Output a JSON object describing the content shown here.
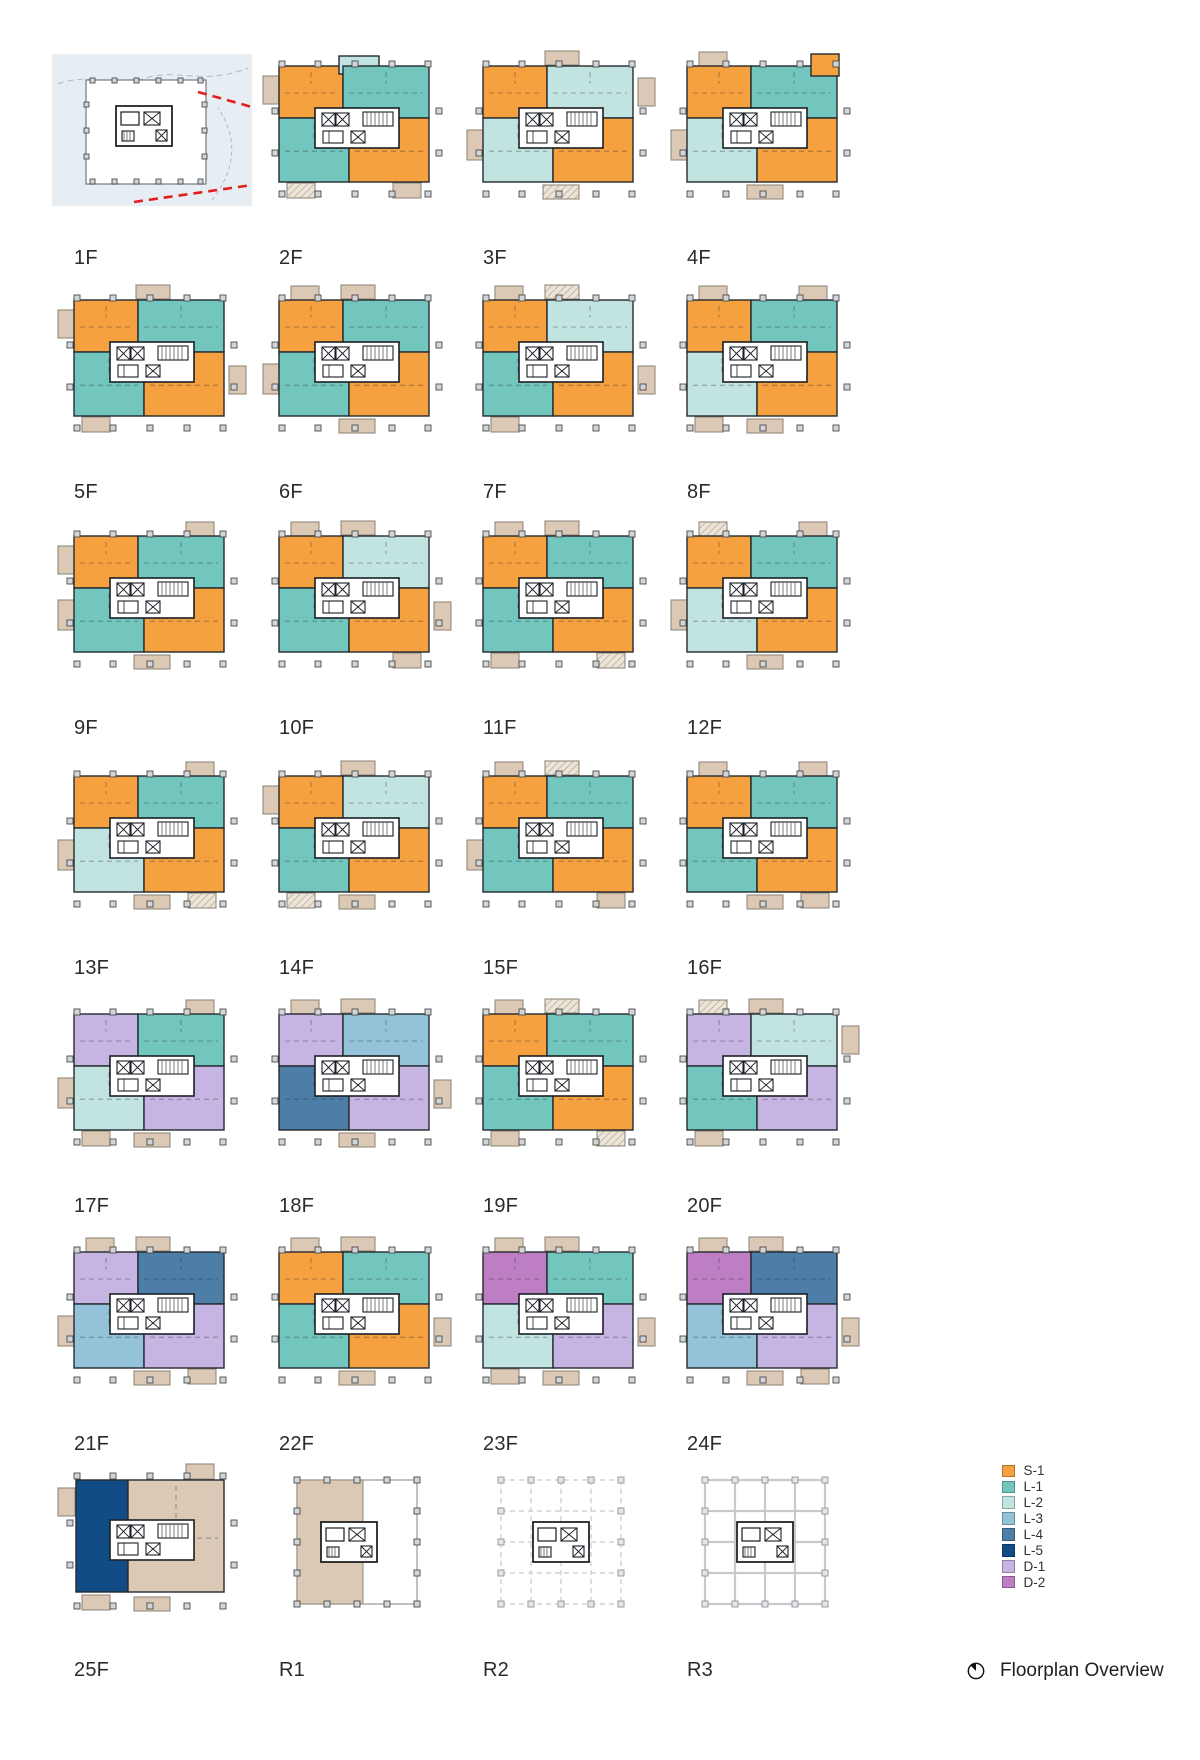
{
  "palette": {
    "S-1": "#F5A140",
    "L-1": "#72C6BD",
    "L-2": "#C2E4E1",
    "L-3": "#94C2D8",
    "L-4": "#4D7EA7",
    "L-5": "#124C87",
    "D-1": "#C6B5E2",
    "D-2": "#BD7EC3",
    "TAN": "#DBC8B5",
    "TAN_BORDER": "#938A7E",
    "UNIT_STROKE": "#232A2F",
    "CORE_STROKE": "#1A1F24",
    "COLUMN_FILL": "#D3D6D8",
    "COLUMN_STROKE": "#4A4A4A",
    "SITE_BG": "#E7EEF3",
    "SITE_LINE_RED": "#E02020",
    "SITE_GREY": "#ADB9C0",
    "ROOF_GRID": "#C6CACF"
  },
  "legend": {
    "items": [
      {
        "key": "S-1",
        "color": "#F5A140"
      },
      {
        "key": "L-1",
        "color": "#72C6BD"
      },
      {
        "key": "L-2",
        "color": "#C2E4E1"
      },
      {
        "key": "L-3",
        "color": "#94C2D8"
      },
      {
        "key": "L-4",
        "color": "#4D7EA7"
      },
      {
        "key": "L-5",
        "color": "#124C87"
      },
      {
        "key": "D-1",
        "color": "#C6B5E2"
      },
      {
        "key": "D-2",
        "color": "#BD7EC3"
      }
    ]
  },
  "footer": {
    "icon": "compass-icon",
    "label": "Floorplan Overview"
  },
  "floors": [
    {
      "label": "1F",
      "type": "site"
    },
    {
      "label": "2F",
      "type": "units",
      "units": {
        "tl": "S-1",
        "tc": "L-2",
        "tr": "L-1",
        "bl": "L-1",
        "br": "S-1"
      },
      "balconies": [
        "lt",
        "bl*",
        "br"
      ]
    },
    {
      "label": "3F",
      "type": "units",
      "units": {
        "tl": "S-1",
        "tr": "L-2",
        "bl": "L-2",
        "br": "S-1"
      },
      "balconies": [
        "tc",
        "lm",
        "rt",
        "bc*"
      ]
    },
    {
      "label": "4F",
      "type": "units",
      "units": {
        "tl": "S-1",
        "tr": "L-1",
        "trx": "S-1",
        "bl": "L-2",
        "br": "S-1"
      },
      "balconies": [
        "tl",
        "lm",
        "bc"
      ]
    },
    {
      "label": "5F",
      "type": "units",
      "units": {
        "tl": "S-1",
        "tr": "L-1",
        "bl": "L-1",
        "br": "S-1"
      },
      "balconies": [
        "tc",
        "lt",
        "rm",
        "bl"
      ]
    },
    {
      "label": "6F",
      "type": "units",
      "units": {
        "tl": "S-1",
        "tr": "L-1",
        "bl": "L-1",
        "br": "S-1"
      },
      "balconies": [
        "tl",
        "tc",
        "lm",
        "bc"
      ]
    },
    {
      "label": "7F",
      "type": "units",
      "units": {
        "tl": "S-1",
        "tr": "L-2",
        "bl": "L-1",
        "br": "S-1"
      },
      "balconies": [
        "tl",
        "tc*",
        "bl",
        "rm"
      ]
    },
    {
      "label": "8F",
      "type": "units",
      "units": {
        "tl": "S-1",
        "tr": "L-1",
        "bl": "L-2",
        "br": "S-1"
      },
      "balconies": [
        "tl",
        "tr",
        "bl",
        "bc"
      ]
    },
    {
      "label": "9F",
      "type": "units",
      "units": {
        "tl": "S-1",
        "tr": "L-1",
        "bl": "L-1",
        "br": "S-1"
      },
      "balconies": [
        "lt",
        "tr",
        "lm",
        "bc"
      ]
    },
    {
      "label": "10F",
      "type": "units",
      "units": {
        "tl": "S-1",
        "tr": "L-2",
        "bl": "L-1",
        "br": "S-1"
      },
      "balconies": [
        "tl",
        "tc",
        "rm",
        "br"
      ]
    },
    {
      "label": "11F",
      "type": "units",
      "units": {
        "tl": "S-1",
        "tr": "L-1",
        "bl": "L-1",
        "br": "S-1"
      },
      "balconies": [
        "tl",
        "tc",
        "bl",
        "br*"
      ]
    },
    {
      "label": "12F",
      "type": "units",
      "units": {
        "tl": "S-1",
        "tr": "L-1",
        "bl": "L-2",
        "br": "S-1"
      },
      "balconies": [
        "tl*",
        "tr",
        "lm",
        "bc"
      ]
    },
    {
      "label": "13F",
      "type": "units",
      "units": {
        "tl": "S-1",
        "tr": "L-1",
        "bl": "L-2",
        "br": "S-1"
      },
      "balconies": [
        "tr",
        "lm",
        "bc",
        "br*"
      ]
    },
    {
      "label": "14F",
      "type": "units",
      "units": {
        "tl": "S-1",
        "tr": "L-2",
        "bl": "L-1",
        "br": "S-1"
      },
      "balconies": [
        "tc",
        "lt",
        "bl*",
        "bc"
      ]
    },
    {
      "label": "15F",
      "type": "units",
      "units": {
        "tl": "S-1",
        "tr": "L-1",
        "bl": "L-1",
        "br": "S-1"
      },
      "balconies": [
        "tl",
        "tc*",
        "lm",
        "br"
      ]
    },
    {
      "label": "16F",
      "type": "units",
      "units": {
        "tl": "S-1",
        "tr": "L-1",
        "bl": "L-1",
        "br": "S-1"
      },
      "balconies": [
        "tl",
        "tr",
        "bc",
        "br"
      ]
    },
    {
      "label": "17F",
      "type": "units",
      "units": {
        "tl": "D-1",
        "tr": "L-1",
        "bl": "L-2",
        "br": "D-1"
      },
      "balconies": [
        "tr",
        "lm",
        "bl",
        "bc"
      ]
    },
    {
      "label": "18F",
      "type": "units",
      "units": {
        "tl": "D-1",
        "tr": "L-3",
        "bl": "L-4",
        "br": "D-1"
      },
      "balconies": [
        "tl",
        "tc",
        "rm",
        "bc"
      ]
    },
    {
      "label": "19F",
      "type": "units",
      "units": {
        "tl": "S-1",
        "tr": "L-1",
        "bl": "L-1",
        "br": "S-1"
      },
      "balconies": [
        "tl",
        "tc*",
        "bl",
        "br*"
      ]
    },
    {
      "label": "20F",
      "type": "units",
      "units": {
        "tl": "D-1",
        "tr": "L-2",
        "bl": "L-1",
        "br": "D-1"
      },
      "balconies": [
        "tl*",
        "tc",
        "rt",
        "bl"
      ]
    },
    {
      "label": "21F",
      "type": "units",
      "units": {
        "tl": "D-1",
        "tr": "L-4",
        "bl": "L-3",
        "br": "D-1"
      },
      "balconies": [
        "tl",
        "tc",
        "lm",
        "bc",
        "br"
      ]
    },
    {
      "label": "22F",
      "type": "units",
      "units": {
        "tl": "S-1",
        "tr": "L-1",
        "bl": "L-1",
        "br": "S-1"
      },
      "balconies": [
        "tl",
        "tc",
        "rm",
        "bc"
      ]
    },
    {
      "label": "23F",
      "type": "units",
      "units": {
        "tl": "D-2",
        "tr": "L-1",
        "bl": "L-2",
        "br": "D-1"
      },
      "balconies": [
        "tl",
        "tc",
        "rm",
        "bl",
        "bc"
      ]
    },
    {
      "label": "24F",
      "type": "units",
      "units": {
        "tl": "D-2",
        "tr": "L-4",
        "bl": "L-3",
        "br": "D-1"
      },
      "balconies": [
        "tl",
        "tc",
        "rm",
        "bc",
        "br"
      ]
    },
    {
      "label": "25F",
      "type": "units",
      "units_custom": [
        {
          "x": 24,
          "y": 18,
          "w": 52,
          "h": 112,
          "c": "L-5"
        },
        {
          "x": 76,
          "y": 18,
          "w": 96,
          "h": 112,
          "c": "TAN"
        }
      ],
      "balconies": [
        "lt",
        "tr",
        "bl",
        "bc"
      ]
    },
    {
      "label": "R1",
      "type": "roof",
      "variant": "tan"
    },
    {
      "label": "R2",
      "type": "roof",
      "variant": "grid-dashed"
    },
    {
      "label": "R3",
      "type": "roof",
      "variant": "grid-solid"
    }
  ]
}
